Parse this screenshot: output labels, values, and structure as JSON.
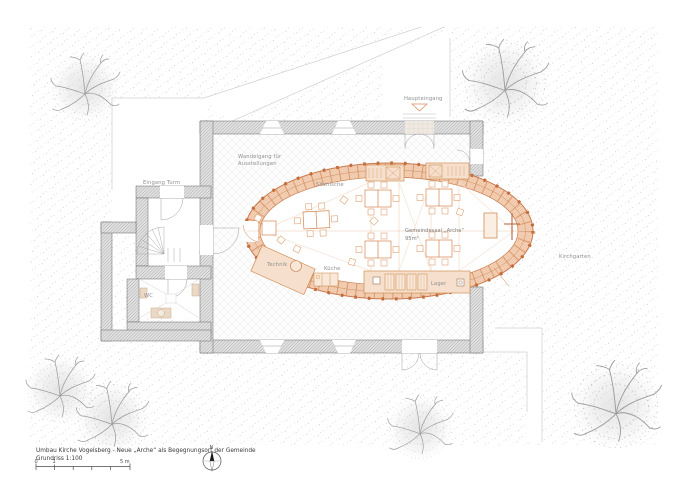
{
  "title_block": {
    "line1": "Umbau Kirche Vogelsberg - Neue „Arche“ als Begegnungsort der Gemeinde",
    "line2": "Grundriss 1:100"
  },
  "scale_bar": {
    "tick0": "0",
    "tick1": "1",
    "tick2": "5 m"
  },
  "compass": {
    "label": "N"
  },
  "rooms": {
    "wandelgang_line1": "Wandelgang für",
    "wandelgang_line2": "Ausstellungen",
    "eingang_turm": "Eingang Turm",
    "haupteingang": "Haupteingang",
    "sitznische": "Sitznische",
    "saal_line1": "Gemeindesaal „Arche“",
    "saal_line2": "95m²",
    "kueche": "Küche",
    "lager": "Lager",
    "technik": "Technik",
    "wc": "WC",
    "kirchgarten": "Kirchgarten"
  },
  "colors": {
    "accent": "#c97a4e",
    "accent_dark": "#b5653a",
    "ring_fill": "#f4d2b8",
    "pod_fill": "#f6e0cd",
    "wall_fill": "#e2e2e2",
    "wall_line": "#8e8e8e",
    "ground_dot": "#a8a8a8",
    "tree": "#9a9a9a",
    "label": "#8f8f8f",
    "fixture": "#ead9c5"
  }
}
